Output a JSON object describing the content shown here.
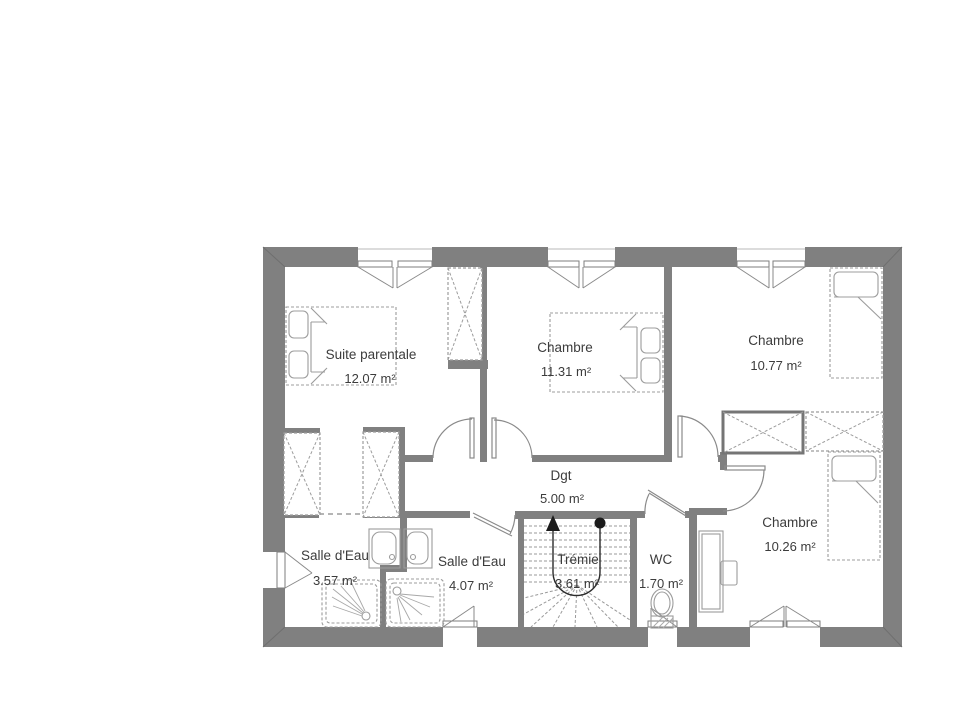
{
  "rooms": [
    {
      "name": "Suite parentale",
      "area": "12.07 m²"
    },
    {
      "name": "Chambre",
      "area": "11.31 m²"
    },
    {
      "name": "Chambre",
      "area": "10.77 m²"
    },
    {
      "name": "Chambre",
      "area": "10.26 m²"
    },
    {
      "name": "Dgt",
      "area": "5.00 m²"
    },
    {
      "name": "Salle d'Eau",
      "area": "3.57 m²"
    },
    {
      "name": "Salle d'Eau",
      "area": "4.07 m²"
    },
    {
      "name": "Trémie",
      "area": "3.61 m²"
    },
    {
      "name": "WC",
      "area": "1.70 m²"
    }
  ],
  "colors": {
    "wall": "#808080",
    "furn": "#9c9c9c",
    "door": "#8a8a8a",
    "text": "#3c3c3c",
    "flight": "#2b2b2b"
  }
}
